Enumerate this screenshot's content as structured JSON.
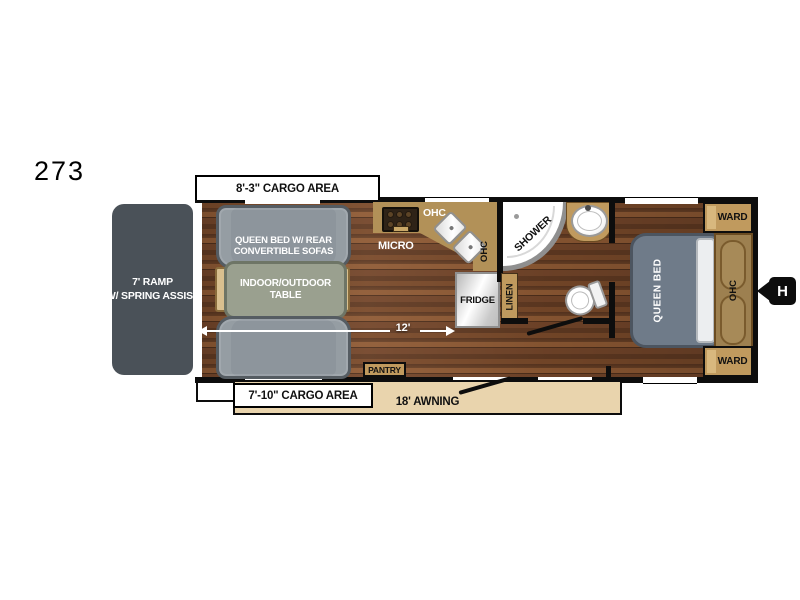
{
  "model": "273",
  "labels": {
    "ramp_line1": "7' RAMP",
    "ramp_line2": "W/ SPRING ASSIST",
    "cargo_top": "8'-3\" CARGO AREA",
    "cargo_bottom": "7'-10\" CARGO AREA",
    "awning": "18' AWNING",
    "sofa_line1": "QUEEN BED W/ REAR",
    "sofa_line2": "CONVERTIBLE SOFAS",
    "table_line1": "INDOOR/OUTDOOR",
    "table_line2": "TABLE",
    "micro": "MICRO",
    "ohc_kitchen": "OHC",
    "ohc_sink": "OHC",
    "shower": "SHOWER",
    "fridge": "FRIDGE",
    "linen": "LINEN",
    "pantry": "PANTRY",
    "queen_bed": "QUEEN BED",
    "ohc_bed": "OHC",
    "ward_front": "WARD",
    "ward_rear": "WARD",
    "hitch": "H",
    "dim_interior": "12'"
  },
  "colors": {
    "wood_dark": "#5a3620",
    "wood_mid": "#7a4a2a",
    "wood_light": "#8f5a34",
    "counter_tan": "#b29158",
    "cabinet_tan": "#c09a5e",
    "cabinet_dark": "#6b4c22",
    "awning_tan": "#e9d4ad",
    "sofa_gray": "#8d959c",
    "sofa_border": "#555c62",
    "table_gray": "#9aa08f",
    "bed_gray": "#6f7b89",
    "bed_border": "#4c5560",
    "ramp_gray": "#4a5158",
    "wall_black": "#0d0d0d"
  }
}
